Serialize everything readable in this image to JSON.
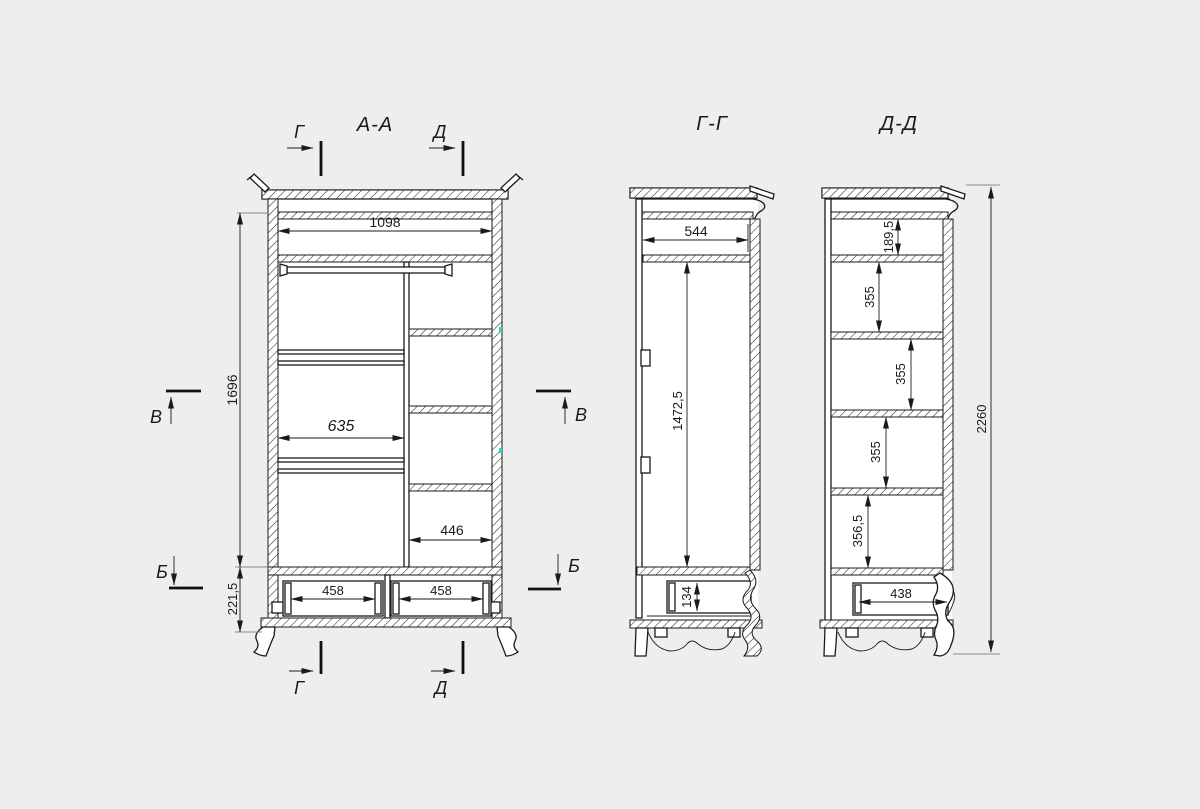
{
  "page": {
    "background": "#eeeeee",
    "ink": "#1a1a1a",
    "highlight_tick": "#2fd3c4"
  },
  "markers": {
    "g": "Г",
    "d": "Д",
    "v": "В",
    "b": "Б"
  },
  "aa": {
    "title": "А-А",
    "dim_top_width": "1098",
    "dim_height": "1696",
    "dim_left_width": "635",
    "dim_right_width": "446",
    "dim_drawer_zone": "221,5",
    "dim_drawer_left": "458",
    "dim_drawer_right": "458"
  },
  "gg": {
    "title": "Г-Г",
    "dim_inner_width": "544",
    "dim_door_height": "1472,5",
    "dim_drawer_height": "134"
  },
  "dd": {
    "title": "Д-Д",
    "dim_top_band": "189,5",
    "dim_shelf1": "355",
    "dim_shelf2": "355",
    "dim_shelf3": "355",
    "dim_shelf_bottom": "356,5",
    "dim_drawer_width": "438",
    "dim_total_height": "2260"
  }
}
